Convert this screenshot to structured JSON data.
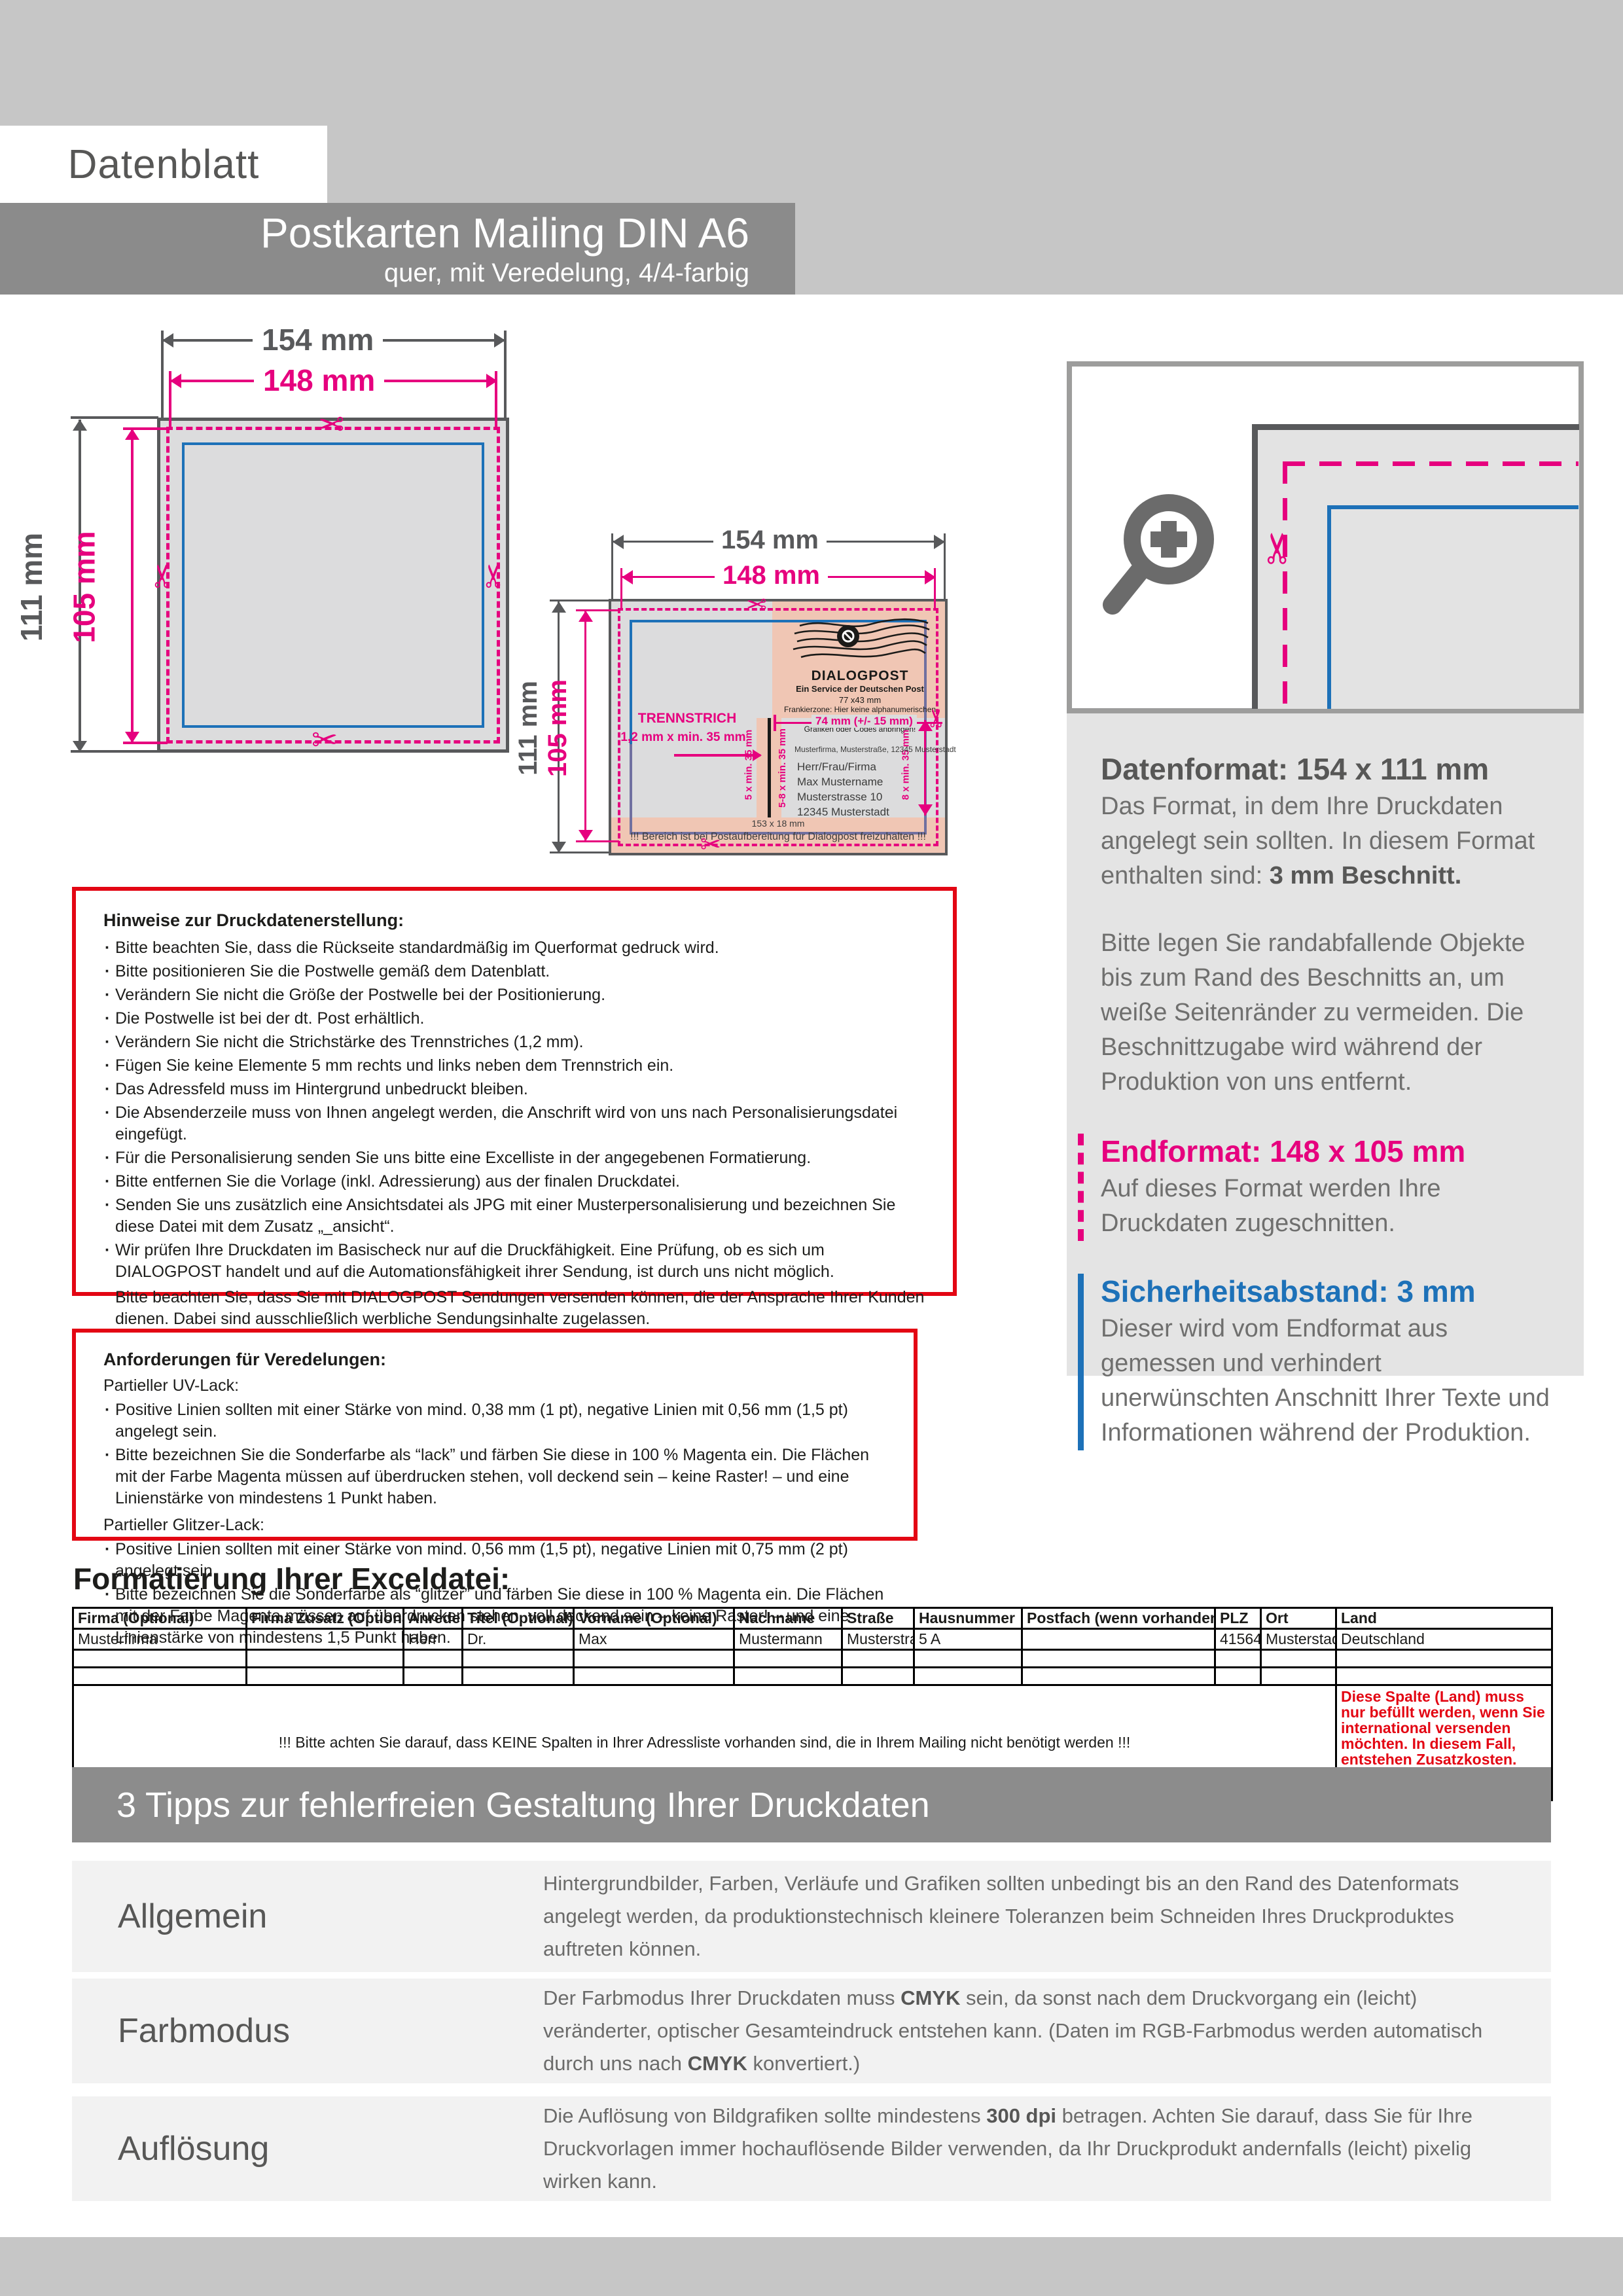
{
  "header": {
    "datenblatt": "Datenblatt",
    "title": "Postkarten Mailing DIN A6",
    "subtitle": "quer, mit Veredelung, 4/4-farbig"
  },
  "colors": {
    "magenta": "#e6007e",
    "blue": "#1d71b8",
    "red": "#e30613",
    "gray": "#58595b"
  },
  "diagram1": {
    "w_outer": "154 mm",
    "w_inner": "148 mm",
    "h_outer": "111 mm",
    "h_inner": "105 mm"
  },
  "diagram2": {
    "w_outer": "154 mm",
    "w_inner": "148 mm",
    "h_outer": "111 mm",
    "h_inner": "105 mm",
    "stamp_title": "DIALOGPOST",
    "stamp_sub": "Ein Service der Deutschen Post",
    "stamp_size": "77 x43 mm",
    "stamp_note1": "Frankierzone: Hier keine alphanumerischen Angaben,",
    "stamp_note2": "Grafiken oder Codes anbringen!",
    "trennstrich_label": "TRENNSTRICH",
    "trennstrich_dim": "1,2 mm x min. 35 mm",
    "dim_74": "74 mm (+/- 15 mm)",
    "dim_5": "5 x min. 35 mm",
    "dim_58": "5-8 x min. 35 mm",
    "dim_8": "8 x min. 35 mm",
    "sender_line": "Musterfirma, Musterstraße, 12345 Musterstadt",
    "address": [
      "Herr/Frau/Firma",
      "Max Mustername",
      "Musterstrasse 10",
      "12345 Musterstadt"
    ],
    "bottom_dim": "153 x 18 mm",
    "bottom_note": "!!! Bereich ist bei Postaufbereitung für Dialogpost freizuhalten !!!"
  },
  "info_panel": {
    "datenformat_title": "Datenformat: 154 x 111 mm",
    "datenformat_text": "Das Format, in dem Ihre Druckdaten angelegt sein sollten. In diesem Format enthalten sind: ",
    "datenformat_bold": "3 mm Beschnitt.",
    "bleed_text": "Bitte legen Sie randabfallende Objekte bis zum Rand des Beschnitts an, um weiße Seitenränder zu vermeiden. Die Beschnittzugabe wird während der Produktion von uns entfernt.",
    "endformat_title": "Endformat: 148 x 105 mm",
    "endformat_text": "Auf dieses Format werden Ihre Druckdaten zugeschnitten.",
    "sicherheit_title": "Sicherheitsabstand: 3 mm",
    "sicherheit_text": "Dieser wird vom Endformat aus gemessen und verhindert unerwünschten Anschnitt Ihrer Texte und Informationen während der Produktion."
  },
  "hinweise": {
    "title": "Hinweise zur Druckdatenerstellung:",
    "bullets": [
      "Bitte beachten Sie,  dass die Rückseite standardmäßig im Querformat gedruck wird.",
      "Bitte positionieren Sie die Postwelle gemäß dem Datenblatt.",
      "Verändern Sie nicht die Größe der Postwelle bei der Positionierung.",
      "Die Postwelle ist bei der dt. Post erhältlich.",
      "Verändern Sie nicht die Strichstärke des Trennstriches (1,2 mm).",
      "Fügen Sie keine Elemente 5 mm rechts und links neben dem Trennstrich ein.",
      "Das Adressfeld muss im Hintergrund unbedruckt bleiben.",
      "Die Absenderzeile muss von Ihnen angelegt werden, die Anschrift wird von uns nach Personalisierungsdatei eingefügt.",
      "Für die Personalisierung senden Sie uns bitte eine Excelliste in der angegebenen Formatierung.",
      "Bitte entfernen Sie die Vorlage (inkl. Adressierung) aus der finalen Druckdatei.",
      "Senden Sie uns zusätzlich eine Ansichtsdatei als JPG mit einer Musterpersonalisierung und bezeichnen Sie diese Datei mit dem Zusatz „_ansicht“.",
      "Wir prüfen Ihre Druckdaten im Basischeck nur auf die Druckfähigkeit. Eine Prüfung, ob es sich um DIALOGPOST handelt und auf die Automationsfähigkeit ihrer Sendung, ist durch uns nicht möglich."
    ],
    "paragraphs": [
      "Bitte beachten Sie, dass Sie mit DIALOGPOST Sendungen versenden können, die der Ansprache Ihrer Kunden dienen. Dabei sind ausschließlich werbliche Sendungsinhalte zugelassen.",
      "Eine unverbindliche Prüfung Ihrer Druckdaten ist bei der deutschen Post unter: https://www.deutschepost.de/de/p/print-mailing/online/pruefen.html  möglich.",
      "Diese Hinweise basieren auf den Informationen der Deutschen Post GmbH, womit hierfür keine Gewähr übernommen werden kann."
    ]
  },
  "veredelung": {
    "title": "Anforderungen für Veredelungen:",
    "uv_title": "Partieller UV-Lack:",
    "uv_b1": "Positive Linien sollten mit einer Stärke von mind. 0,38 mm (1 pt), negative Linien mit 0,56 mm (1,5 pt) angelegt sein.",
    "uv_b2": "Bitte bezeichnen Sie die Sonderfarbe als “lack” und färben Sie diese in 100 % Magenta ein. Die Flächen mit der Farbe Magenta müssen auf überdrucken stehen, voll deckend sein – keine Raster! – und eine Linienstärke von mindestens 1 Punkt haben.",
    "glitzer_title": "Partieller Glitzer-Lack:",
    "gl_b1": "Positive Linien sollten mit einer Stärke von mind. 0,56 mm (1,5 pt), negative Linien mit 0,75 mm (2 pt) angelegt sein.",
    "gl_b2": "Bitte bezeichnen Sie die Sonderfarbe als “glitzer” und färben Sie diese in 100 % Magenta ein. Die Flächen mit der Farbe Magenta müssen auf überdrucken stehen, voll deckend sein – keine Raster! – und eine Linienstärke von mindestens 1,5 Punkt haben."
  },
  "excel": {
    "heading": "Formatierung Ihrer Exceldatei:",
    "headers": [
      "Firma (Optional)",
      "Firma Zusatz (Optional)",
      "Anrede",
      "Titel  (Optional)",
      "Vorname (Optional)",
      "Nachname",
      "Straße",
      "Hausnummer",
      "Postfach (wenn vorhanden)",
      "PLZ",
      "Ort",
      "Land"
    ],
    "row1": [
      "Musterfirma",
      "",
      "Herr",
      "Dr.",
      "Max",
      "Mustermann",
      "Musterstraße",
      "5 A",
      "",
      "41564",
      "Musterstadt",
      "Deutschland"
    ],
    "note_center": "!!! Bitte achten Sie darauf, dass KEINE Spalten in Ihrer Adressliste vorhanden sind, die in Ihrem Mailing nicht benötigt werden !!!",
    "note_land": "Diese Spalte (Land) muss nur befüllt werden, wenn Sie international versenden möchten. In diesem Fall, entstehen Zusatzkosten. Diese werden nachberechnet."
  },
  "tips": {
    "heading": "3 Tipps zur fehlerfreien Gestaltung Ihrer Druckdaten",
    "row1_label": "Allgemein",
    "row1_text": "Hintergrundbilder, Farben, Verläufe und Grafiken sollten unbedingt bis an den Rand des Datenformats angelegt werden, da produktionstechnisch kleinere Toleranzen beim Schneiden Ihres Druckproduktes auftreten können.",
    "row2_label": "Farbmodus",
    "row2_t1": "Der Farbmodus Ihrer Druckdaten muss ",
    "row2_b1": "CMYK",
    "row2_t2": " sein, da sonst nach dem Druckvorgang ein (leicht) veränderter, optischer Gesamteindruck entstehen kann. (Daten im RGB-Farbmodus werden automatisch durch uns nach ",
    "row2_b2": "CMYK",
    "row2_t3": " konvertiert.)",
    "row3_label": "Auflösung",
    "row3_t1": "Die Auflösung von Bildgrafiken sollte mindestens ",
    "row3_b1": "300 dpi",
    "row3_t2": " betragen. Achten Sie darauf, dass Sie für Ihre Druckvorlagen immer hochauflösende Bilder verwenden, da Ihr Druckprodukt andernfalls (leicht) pixelig wirken kann."
  }
}
